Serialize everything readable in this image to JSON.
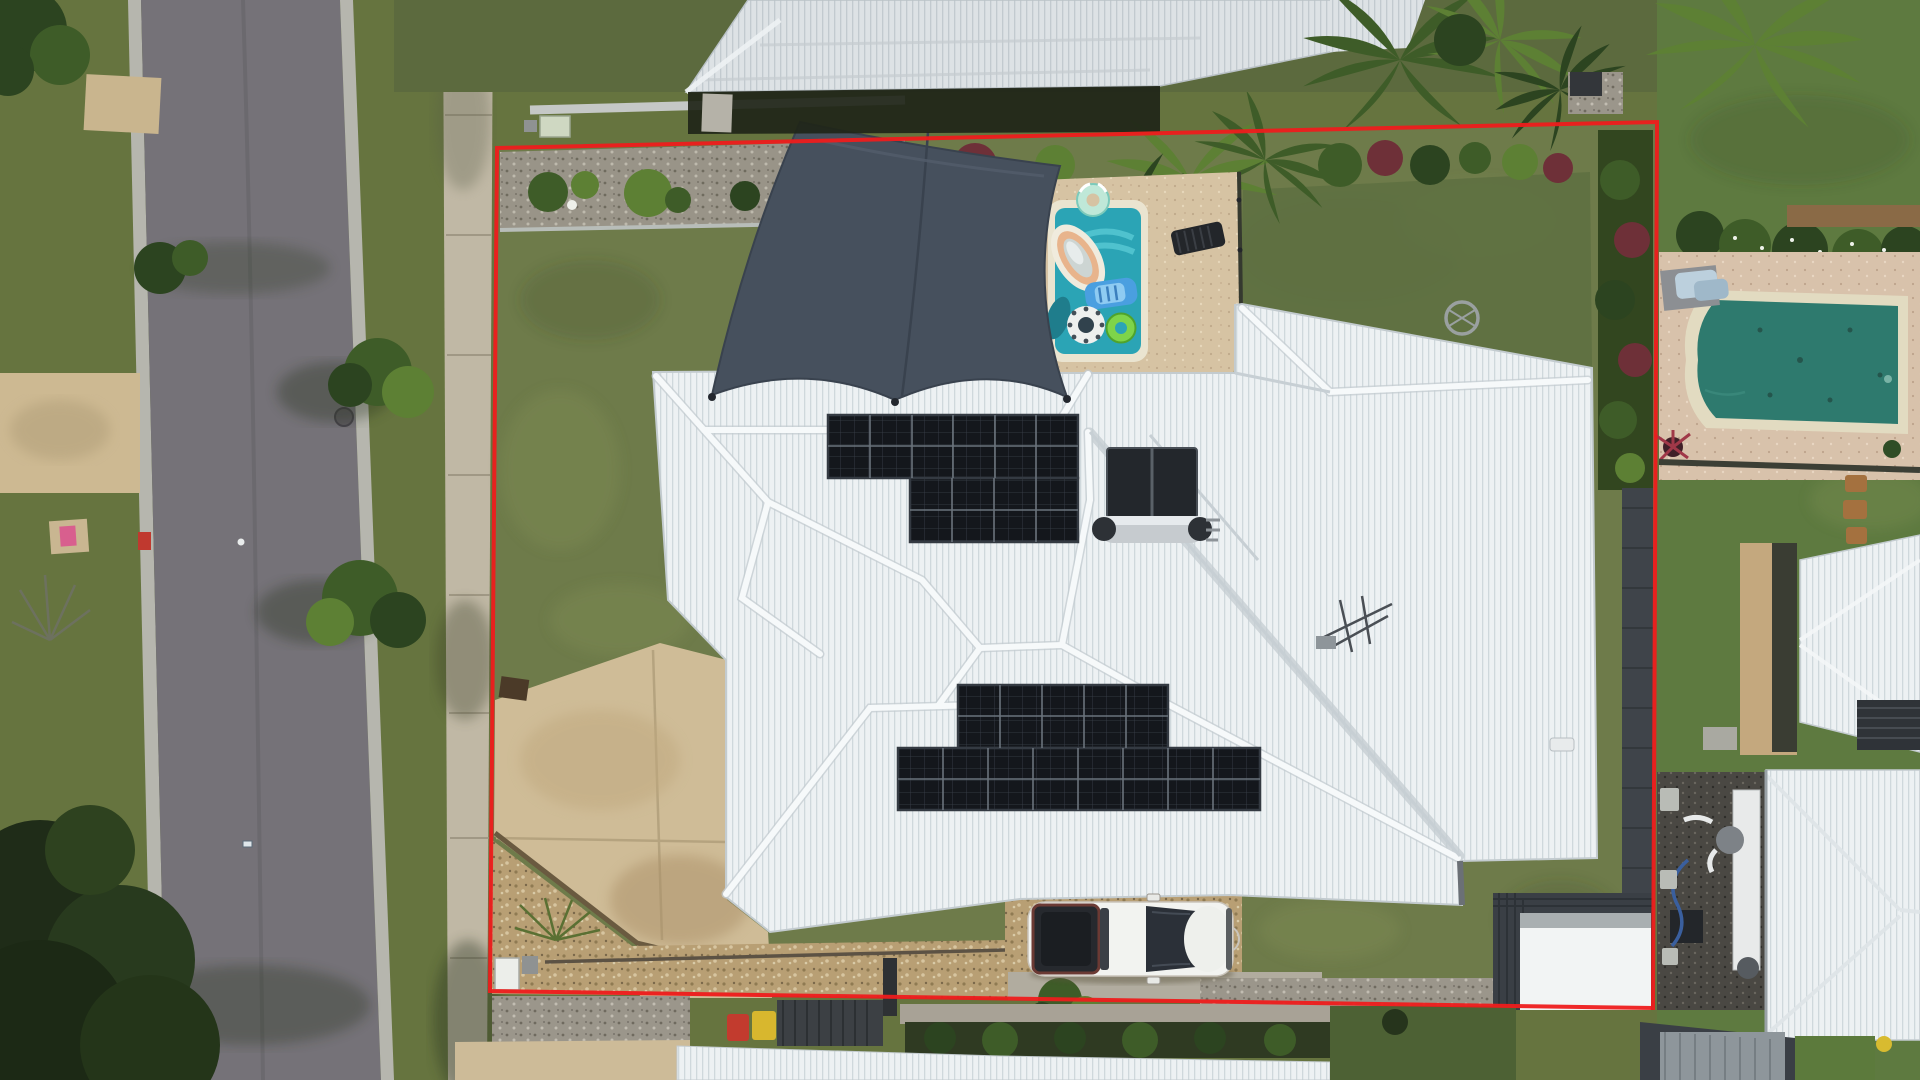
{
  "meta": {
    "type": "aerial-drone-photograph",
    "description": "Top-down drone photo of a suburban property outlined with a red boundary. A large white corrugated hip roof carries two rooftop solar arrays and a solar hot-water system. A dark shade sail covers a small backyard pool filled with floaties. A white ute is parked on a gravel pad at the rear. A street, footpath and neighbouring houses with pools surround the lot.",
    "canvas": {
      "width": 1920,
      "height": 1080
    }
  },
  "colors": {
    "boundary_red": "#ee1c1c",
    "asphalt": "#757278",
    "curb": "#b6b6ae",
    "sidewalk": "#c0b8a5",
    "verge_grass": "#66743f",
    "yard_grass": "#6e7b4a",
    "ne_lawn": "#5e6f41",
    "neighbor_lawn": "#587a3a",
    "dark_lawn": "#4d6134",
    "driveway": "#cfbc97",
    "roof_white": "#edf1f3",
    "roof_top_neighbor": "#dde2e5",
    "shade_sail": "#46505d",
    "sail_seam": "#39424e",
    "pool_water": "#2ba4b5",
    "pool_water_light": "#4cc3cd",
    "pool_coping": "#eae4d0",
    "paving": "#d6c3a3",
    "neighbor_pool_water": "#2e7a6e",
    "neighbor_pool_coping": "#e2dbc1",
    "solar_panel": "#14171c",
    "panel_frame": "#343a42",
    "hw_tank": "#c6cbcf",
    "car_body": "#f2f3f0",
    "car_glass": "#2b3038",
    "car_tray": "#26292e",
    "car_trim": "#6b3a34",
    "gravel_brown": "#b2996e",
    "gravel_gray": "#9b968b",
    "dark_gravel": "#4a4843",
    "fence_dark": "#3f444a",
    "shed_dark": "#3a3f45",
    "shed_white": "#f2f4f4",
    "hedge_dark": "#2f3a22",
    "bin_red": "#c23b2e",
    "bin_yellow": "#d8b72e",
    "utility_box": "#cfd8c2"
  },
  "boundary": {
    "corners": [
      [
        497,
        148
      ],
      [
        1657,
        122
      ],
      [
        1653,
        1008
      ],
      [
        490,
        991
      ]
    ],
    "stroke_width": 4
  },
  "objects": {
    "street": "asphalt road, left side, running vertically",
    "footpath": "concrete footpath between street and boundary",
    "main_house": "white corrugated hip roof with multiple ridges",
    "solar_upper_array": "12+8 panel array, upper roof face",
    "solar_lower_array": "10+16 panel array, lower roof face",
    "solar_hot_water": "two dark collectors with horizontal silver tank",
    "shade_sail": "dark slate 4-point shade sail over pool corner",
    "pool": "small teal pool with lounger, ring and chair floaties",
    "floaties": [
      "striped lounger",
      "blue chair float",
      "polka-dot ring",
      "green ring",
      "mint striped ring on deck"
    ],
    "ute": "white dual-cab ute parked on gravel pad, rear of lot",
    "neighbor_pool_right": "dark teal rectangular pool with cream coping",
    "sheds": "dark grey and white garden sheds, bottom-right of lot",
    "bins": "red and yellow wheelie bins behind rear fence"
  }
}
